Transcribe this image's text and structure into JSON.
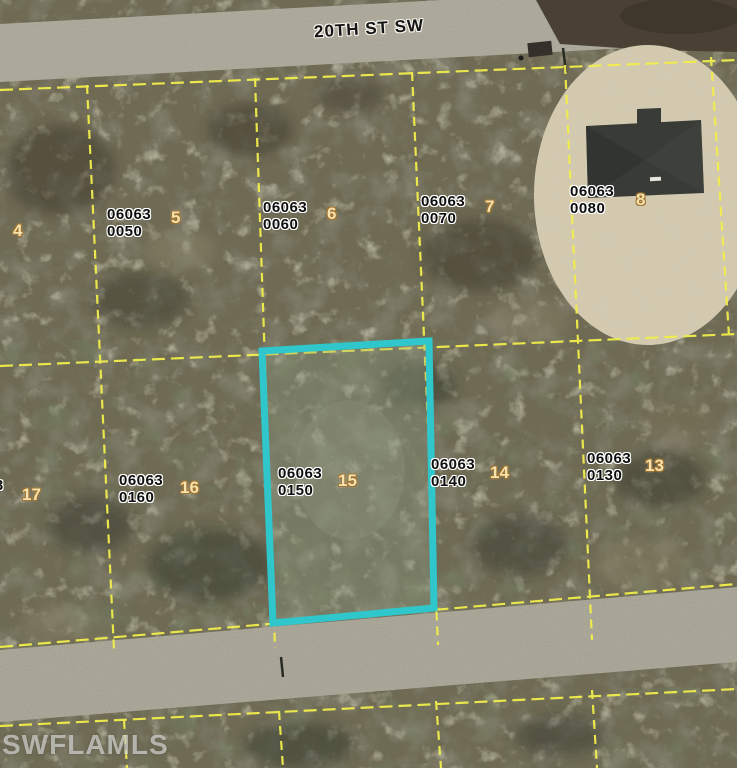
{
  "street": {
    "label": "20TH ST SW"
  },
  "watermark": {
    "label": "SWFLAMLS"
  },
  "colors": {
    "parcel_line": "#f1ee4c",
    "highlight_outline": "#2fc7cb",
    "lot_number_text": "#f5e3b0",
    "strap_label_text": "#0e0e0e"
  },
  "parcels": {
    "p0040": {
      "strap_fragment": "3",
      "lot": "4"
    },
    "p0050": {
      "strap_line1": "06063",
      "strap_line2": "0050",
      "lot": "5"
    },
    "p0060": {
      "strap_line1": "06063",
      "strap_line2": "0060",
      "lot": "6"
    },
    "p0070": {
      "strap_line1": "06063",
      "strap_line2": "0070",
      "lot": "7"
    },
    "p0080": {
      "strap_line1": "06063",
      "strap_line2": "0080",
      "lot": "8"
    },
    "p0170": {
      "strap_line1_fragment": "63",
      "strap_line2_fragment": "0",
      "lot": "17"
    },
    "p0160": {
      "strap_line1": "06063",
      "strap_line2": "0160",
      "lot": "16"
    },
    "p0150": {
      "strap_line1": "06063",
      "strap_line2": "0150",
      "lot": "15",
      "highlighted": "true"
    },
    "p0140": {
      "strap_line1": "06063",
      "strap_line2": "0140",
      "lot": "14"
    },
    "p0130": {
      "strap_line1": "06063",
      "strap_line2": "0130",
      "lot": "13"
    }
  }
}
